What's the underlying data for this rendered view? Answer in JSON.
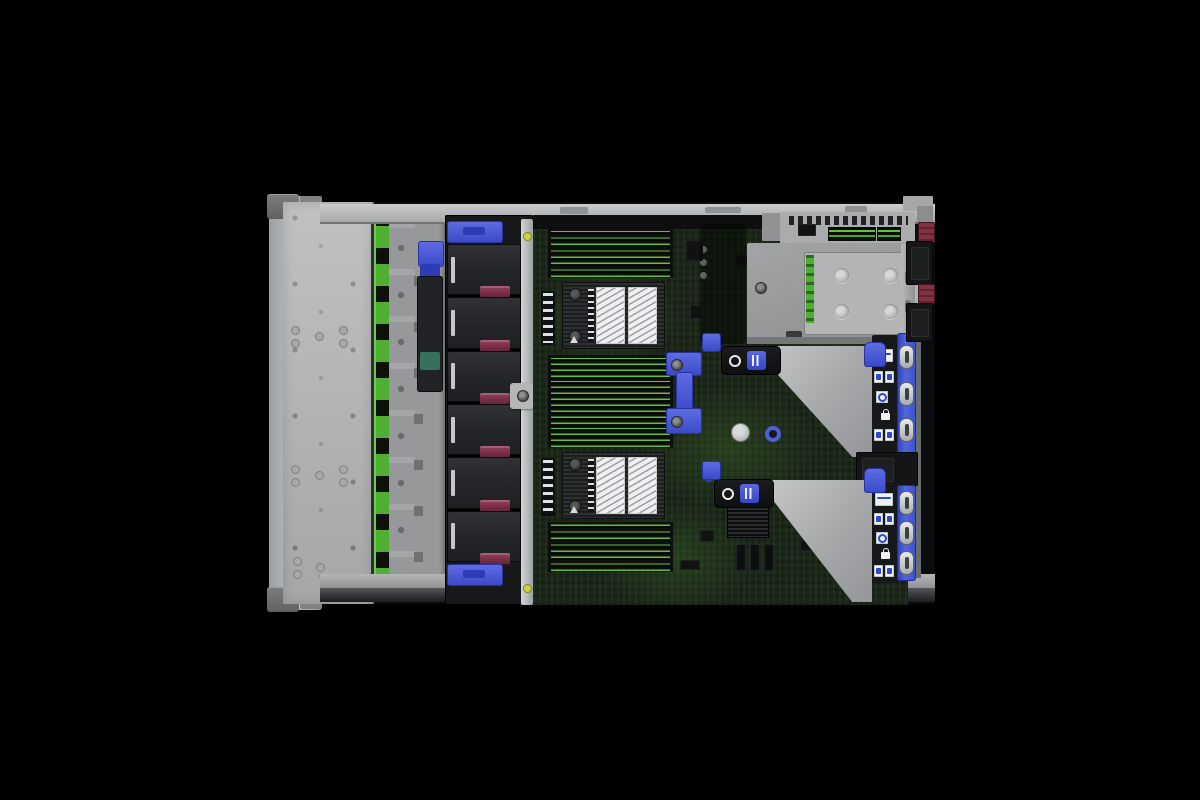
{
  "scene": {
    "description": "Top-down interior view of a 2U rack-mount server with the access panel removed, photographed on a black background",
    "background_color": "#000000"
  },
  "colors": {
    "chassis_gray": "#b3b5b7",
    "tray_gray": "#9da0a2",
    "accent_blue": "#4c5cd6",
    "accent_blue_dark": "#2f3fae",
    "maroon": "#7c3048",
    "psu_maroon": "#7d2c3c",
    "backplane_green": "#4fae33",
    "dimm_green": "#63bd3c",
    "pcb_green": "#1c261a",
    "fan_black": "#232427",
    "panel_black": "#141517",
    "label_white": "#eef0f1",
    "silver": "#c6c8ca",
    "yellow_dot": "#ccd23e"
  },
  "front_section": {
    "drive_cage_panel": "blank sheet-metal top over drive bays",
    "backplane_connector_count": 10
  },
  "fan_bank": {
    "fan_count": 6,
    "handle_count": 2
  },
  "memory": {
    "banks": [
      {
        "name": "dimm-bank-front",
        "slots": 8
      },
      {
        "name": "dimm-bank-middle",
        "slots": 16
      },
      {
        "name": "dimm-bank-rear",
        "slots": 8
      }
    ]
  },
  "cpus": {
    "count": 2,
    "labels_per_heatsink": 2
  },
  "risers": {
    "cage_count": 2,
    "latches_per_strip": 3
  },
  "rear": {
    "ocp_tray_holes": 4,
    "psu_handles": 2
  }
}
